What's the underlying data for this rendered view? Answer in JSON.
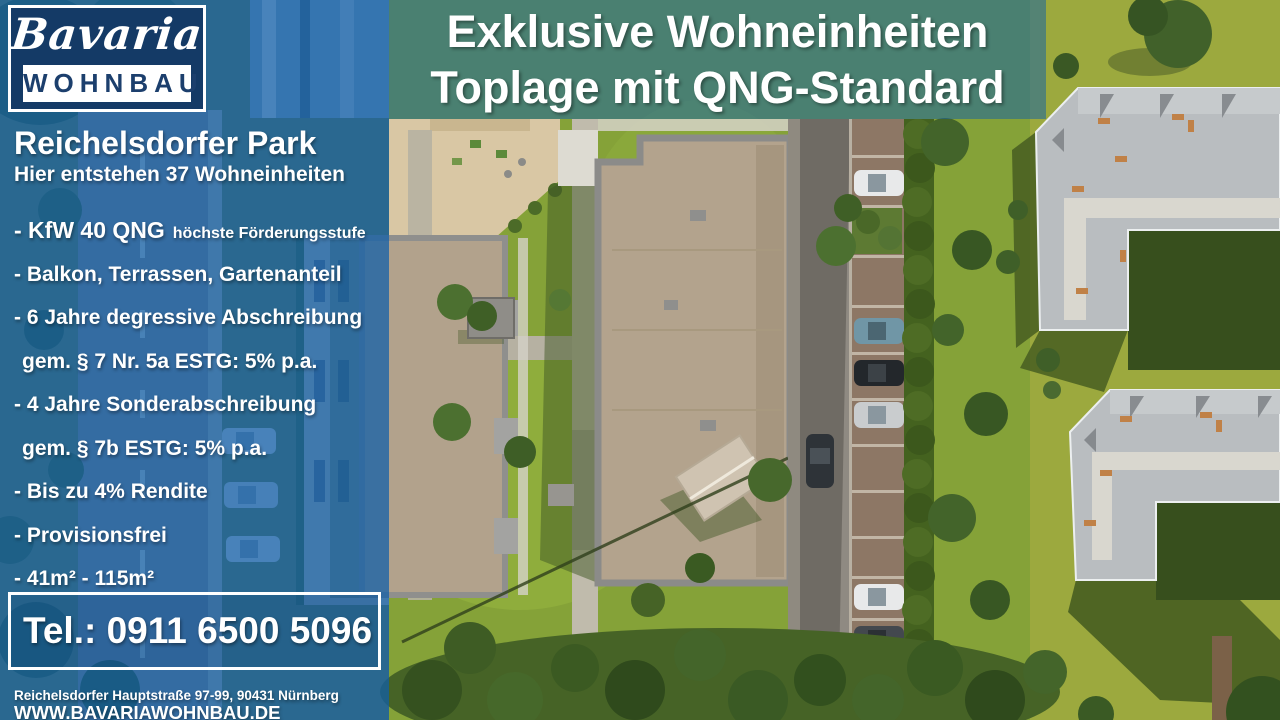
{
  "brand": {
    "logo_script": "Bavaria",
    "logo_word": "WOHNBAU"
  },
  "headline": {
    "line1": "Exklusive Wohneinheiten",
    "line2": "Toplage mit QNG-Standard"
  },
  "project": {
    "title": "Reichelsdorfer Park",
    "subtitle": "Hier entstehen 37 Wohneinheiten"
  },
  "features": [
    {
      "text": "- KfW 40 QNG",
      "suffix": "höchste Förderungsstufe"
    },
    {
      "text": "- Balkon, Terrassen, Gartenanteil"
    },
    {
      "text": "- 6 Jahre degressive Abschreibung"
    },
    {
      "text": "gem. § 7 Nr. 5a ESTG: 5% p.a."
    },
    {
      "text": "- 4 Jahre Sonderabschreibung"
    },
    {
      "text": "gem. § 7b ESTG: 5% p.a."
    },
    {
      "text": "- Bis zu 4% Rendite"
    },
    {
      "text": "- Provisionsfrei"
    },
    {
      "text": "- 41m² - 115m²"
    }
  ],
  "contact": {
    "phone": "Tel.: 0911 6500 5096",
    "address": "Reichelsdorfer Hauptstraße 97-99, 90431 Nürnberg",
    "website": "WWW.BAVARIAWOHNBAU.DE"
  },
  "colors": {
    "overlay_blue": "#105ea8",
    "logo_navy": "#143a66",
    "grass_olive": "#9ca93e",
    "grass_lawn": "#85a238",
    "roof_gray": "#b9bdc0",
    "roof_tan": "#b3a38d"
  }
}
